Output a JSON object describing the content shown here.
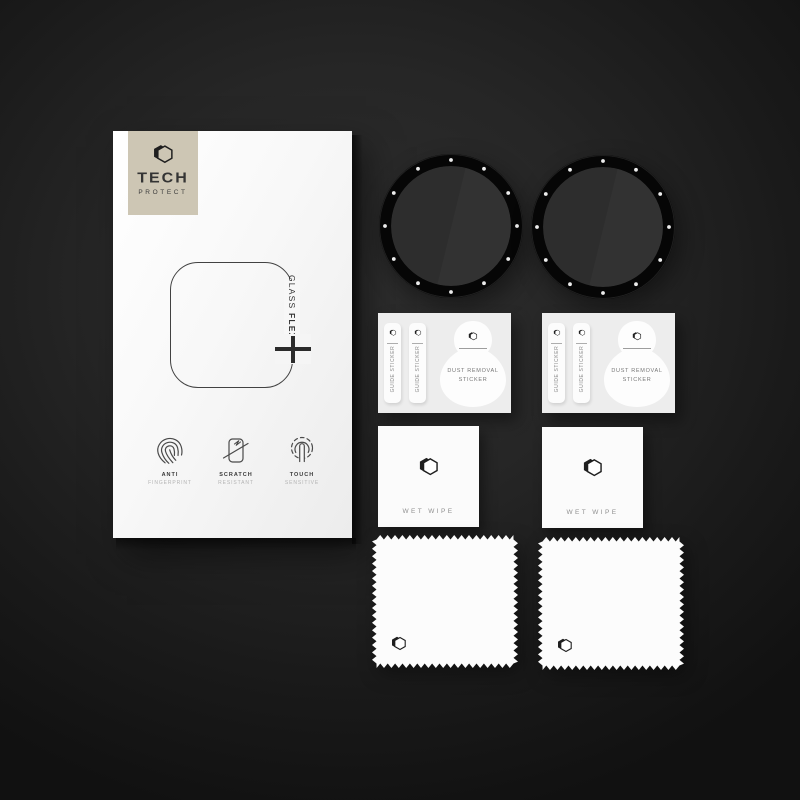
{
  "scene": {
    "description": "Tech Protect Glass Flex smartwatch screen protector kit flat lay on dark background",
    "item_counts": {
      "protectors": 2,
      "sticker_cards": 2,
      "wet_wipes": 2,
      "cloths": 2
    }
  },
  "brand": {
    "name_top": "TECH",
    "name_bottom": "PROTECT"
  },
  "box": {
    "product_name_thin": "GLASS",
    "product_name_bold": "FLEX",
    "features": [
      {
        "icon": "fingerprint-icon",
        "title": "ANTI",
        "subtitle": "FINGERPRINT"
      },
      {
        "icon": "scratch-phone-icon",
        "title": "SCRATCH",
        "subtitle": "RESISTANT"
      },
      {
        "icon": "touch-finger-icon",
        "title": "TOUCH",
        "subtitle": "SENSITIVE"
      }
    ]
  },
  "protectors": [
    {
      "name": "round watch glass protector",
      "tick_dots": 12
    },
    {
      "name": "round watch glass protector",
      "tick_dots": 12
    }
  ],
  "sticker_cards": [
    {
      "guide_sticker_1": "GUIDE STICKER",
      "guide_sticker_2": "GUIDE STICKER",
      "dust_line_1": "DUST REMOVAL",
      "dust_line_2": "STICKER"
    },
    {
      "guide_sticker_1": "GUIDE STICKER",
      "guide_sticker_2": "GUIDE STICKER",
      "dust_line_1": "DUST REMOVAL",
      "dust_line_2": "STICKER"
    }
  ],
  "wet_wipes": [
    {
      "label": "WET WIPE"
    },
    {
      "label": "WET WIPE"
    }
  ],
  "colors": {
    "background": "#1e1e1e",
    "box_face": "#f7f7f7",
    "brand_badge": "#cdc6b4",
    "protector_ring": "#070707",
    "protector_glass": "#2d2d2d",
    "card_base": "#ededed",
    "sticker_white": "#fcfcfc",
    "ink": "#333333",
    "muted_text": "#8f8f8f"
  }
}
